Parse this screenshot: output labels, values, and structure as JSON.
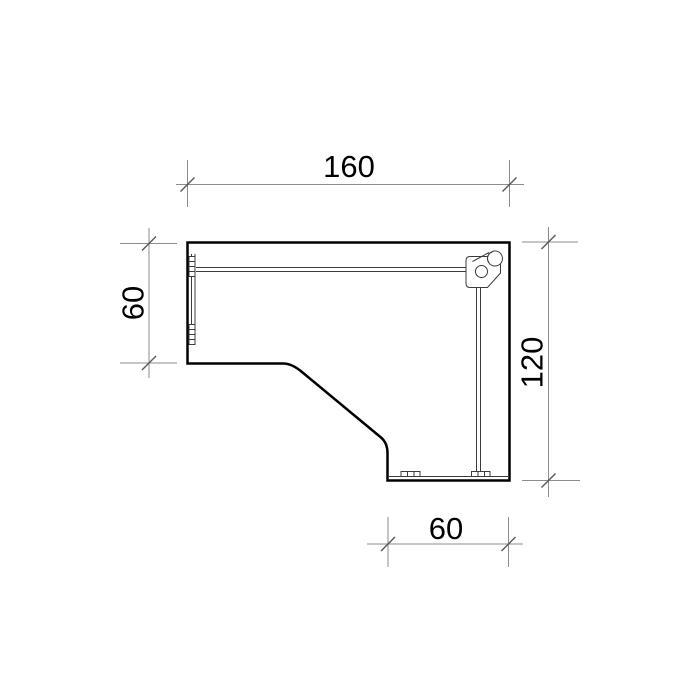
{
  "drawing": {
    "dimensions": {
      "top": {
        "value": "160"
      },
      "left": {
        "value": "60"
      },
      "right": {
        "value": "120"
      },
      "bottom": {
        "value": "60"
      }
    },
    "colors": {
      "background": "#ffffff",
      "outline": "#000000",
      "detail": "#3c3c3c",
      "dimension_line": "#8c8c8c",
      "tick": "#5a5a5a",
      "text": "#000000"
    }
  }
}
